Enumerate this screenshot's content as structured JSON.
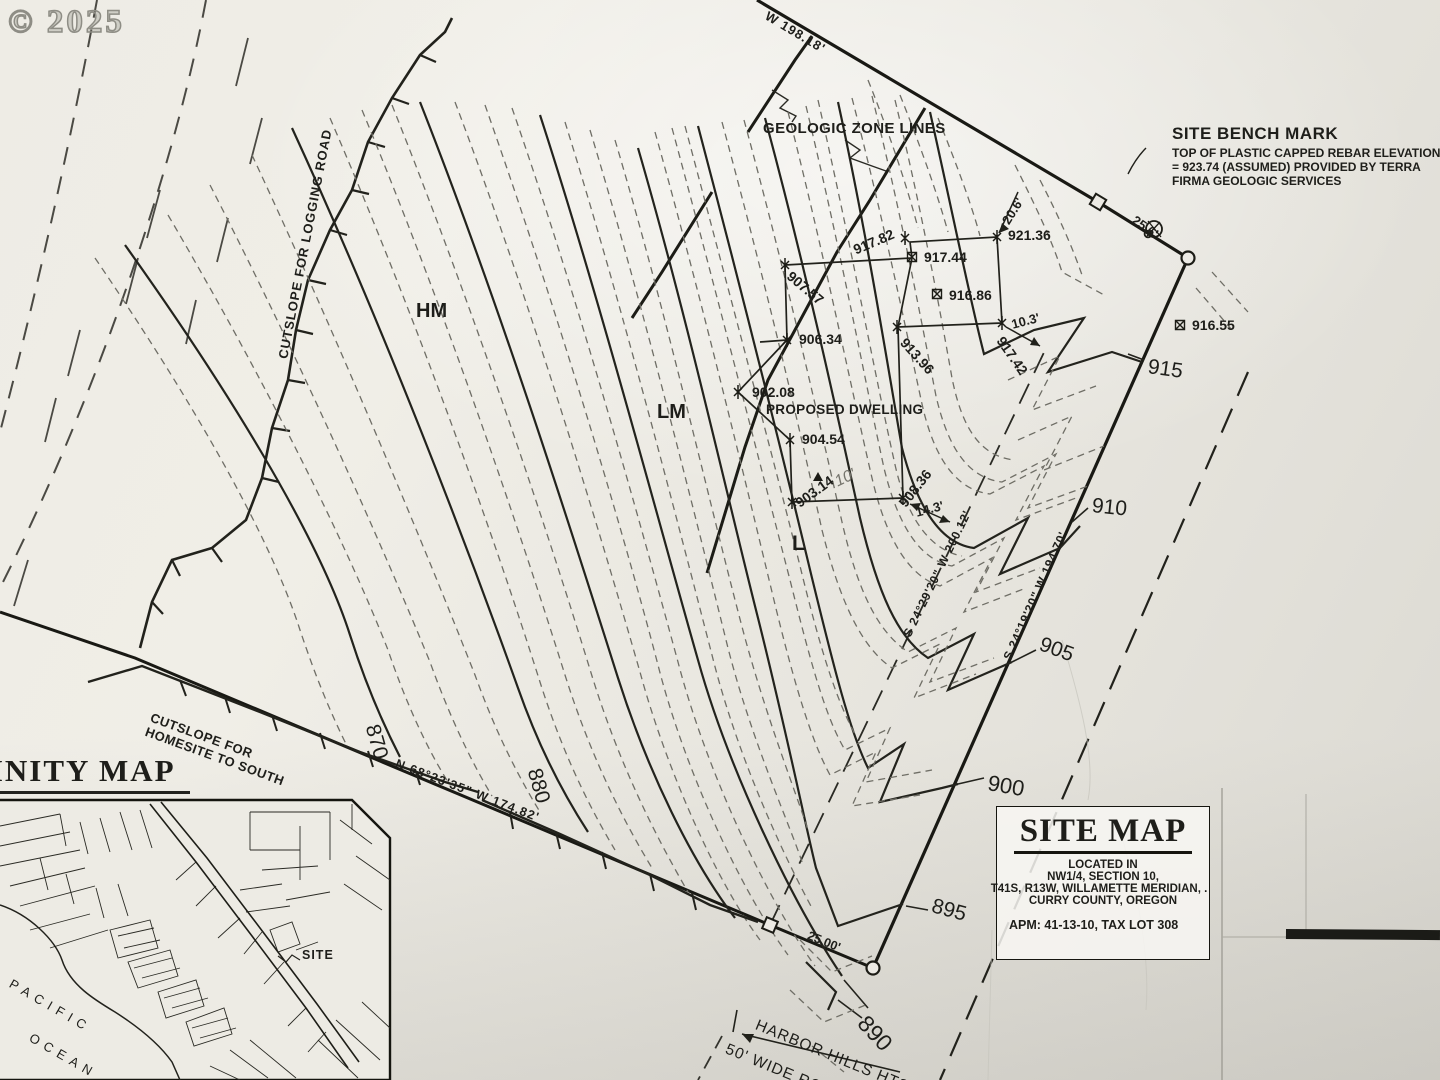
{
  "watermark": "© 2025",
  "benchmark": {
    "title": "SITE BENCH MARK",
    "l1": "TOP OF PLASTIC CAPPED REBAR ELEVATION",
    "l2": "= 923.74 (ASSUMED) PROVIDED BY TERRA",
    "l3": "FIRMA GEOLOGIC SERVICES"
  },
  "labels": {
    "geozone": "GEOLOGIC ZONE LINES",
    "dwelling": "PROPOSED DWELLING",
    "cut_logging": "CUTSLOPE FOR LOGGING ROAD",
    "cut_home1": "CUTSLOPE FOR",
    "cut_home2": "HOMESITE TO SOUTH",
    "hm": "HM",
    "lm": "LM",
    "l": "L",
    "harbor": "HARBOR HILLS HTS. RD.",
    "roadway": "50' WIDE ROADWAY",
    "hand10": "10'"
  },
  "bearings": {
    "top": "W  198.18'",
    "bottom_left": "N 68°23'35\" W  174.82'",
    "easement": "S 24°29'20\" W  200.12'",
    "property": "S 24°19'20\" W  194.70'"
  },
  "dims": {
    "d206": "20.6'",
    "d256": "25.6'",
    "d103": "10.3'",
    "d143": "14.3'",
    "d2500": "25.00'"
  },
  "spots": [
    "917.82",
    "921.36",
    "917.44",
    "916.86",
    "916.55",
    "913.96",
    "917.42",
    "907.57",
    "906.34",
    "902.08",
    "904.54",
    "903.14",
    "908.36"
  ],
  "contours": [
    "915",
    "910",
    "905",
    "900",
    "895",
    "890",
    "880",
    "870"
  ],
  "title_block": {
    "title": "SITE MAP",
    "sub1": "LOCATED IN",
    "sub2": "NW1/4, SECTION 10,",
    "sub3": "T41S, R13W, WILLAMETTE MERIDIAN, .",
    "sub4": "CURRY COUNTY, OREGON",
    "apm": "APM: 41-13-10, TAX LOT 308"
  },
  "vicinity": {
    "title": "VICINITY MAP",
    "pacific": "PACIFIC",
    "ocean": "OCEAN",
    "site": "SITE"
  }
}
